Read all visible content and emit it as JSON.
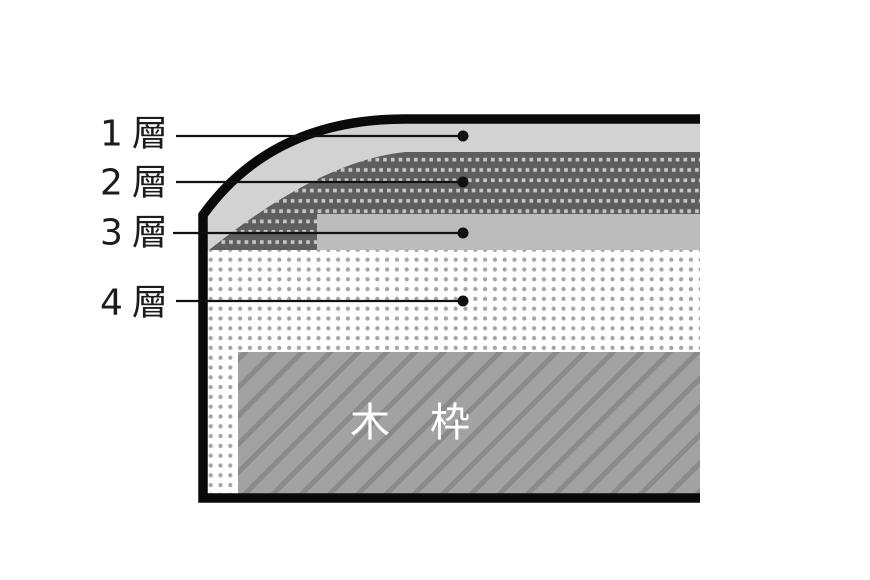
{
  "figure": {
    "type": "layer-structure-cross-section-diagram",
    "background_color": "#ffffff",
    "border_color": "#0a0a0a",
    "callouts": [
      {
        "label": "1層",
        "points_to": "layer-1"
      },
      {
        "label": "2層",
        "points_to": "layer-2"
      },
      {
        "label": "3層",
        "points_to": "layer-3"
      },
      {
        "label": "4層",
        "points_to": "layer-4"
      }
    ],
    "layers": [
      {
        "name": "layer-1",
        "appearance": "solid light gray band under outer skin",
        "color": "#d2d2d2"
      },
      {
        "name": "layer-2",
        "appearance": "dark gray band with light square dash pattern, wraps down at corner",
        "color": "#5e5e5e",
        "pattern_color": "#c7c7c7"
      },
      {
        "name": "layer-3",
        "appearance": "solid medium gray band",
        "color": "#bcbcbc"
      },
      {
        "name": "layer-4",
        "appearance": "white band with gray dot grid",
        "color": "#ffffff",
        "pattern_color": "#a5a5a5"
      }
    ],
    "wood_frame": {
      "label": "木　枠",
      "appearance": "gray block with darker diagonal hatching",
      "color": "#a2a2a2",
      "pattern_color": "#8a8a8a",
      "label_color": "#ffffff"
    }
  }
}
